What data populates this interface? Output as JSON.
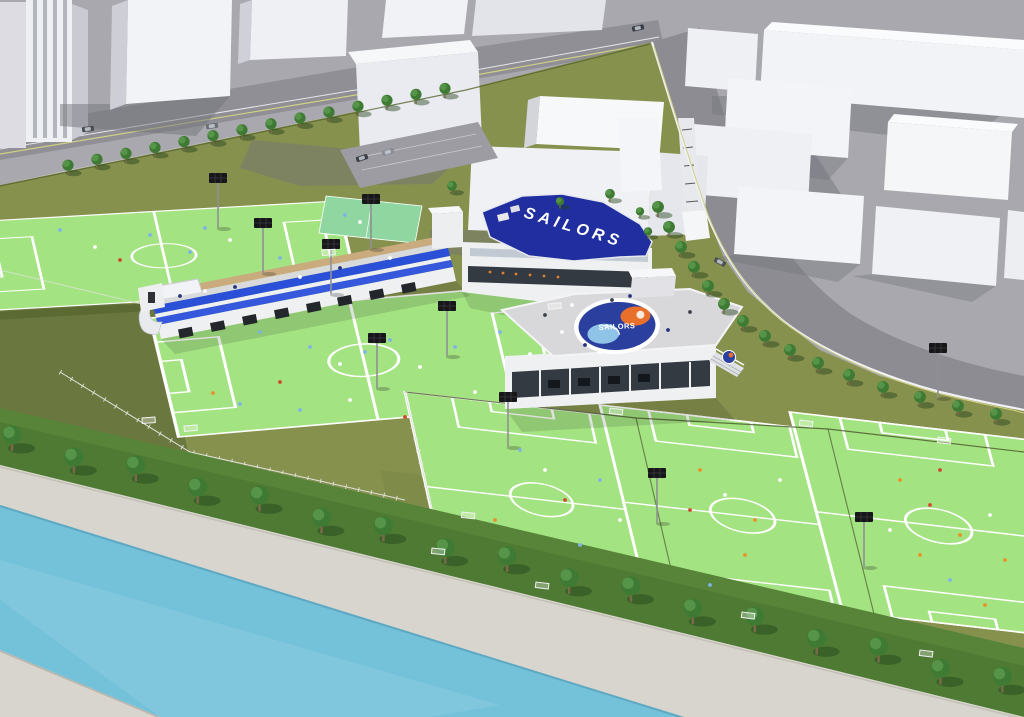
{
  "scene": {
    "description": "Aerial 3D architectural rendering of a riverside football training centre: five bright-green pitches, a blue-roofed SAILORS clubhouse, a rooftop crest plaza building, a grandstand with blue seating, tree-lined canal promenade, curving perimeter road and surrounding white city blocks",
    "labels": {
      "main_roof": "SAILORS",
      "plaza_crest": "SAILORS"
    },
    "colors": {
      "bg": "#cdced3",
      "city_ground": "#a8a8ae",
      "road": "#8f8f95",
      "road_edge": "#cfd084",
      "building_top": "#f7f8fa",
      "building_front": "#f0f1f4",
      "building_side": "#c9cad2",
      "building_shadow": "#73737c",
      "facility_base": "#87914e",
      "hedge": "#5b6a33",
      "pitch_green": "#a4e382",
      "pitch_line": "#ffffff",
      "stand_blue": "#2b50d8",
      "stand_white": "#eef0f2",
      "planter_tan": "#c9ab7e",
      "roof_blue": "#202e9f",
      "crest_blue": "#2b3f9e",
      "crest_orange": "#e8702a",
      "crest_sky": "#8fc3e8",
      "tree_green": "#3e7a33",
      "tree_light": "#569549",
      "strip_green": "#4e7a33",
      "concrete": "#d8d5ce",
      "water": "#74c1da",
      "fence_white": "#f0f1f4",
      "glass_dark": "#343a41",
      "pole": "#8f8f96"
    },
    "player_colors": [
      "#ffffff",
      "#7fb3e8",
      "#d04a32",
      "#e8912a",
      "#24357e",
      "#3c424c"
    ]
  }
}
